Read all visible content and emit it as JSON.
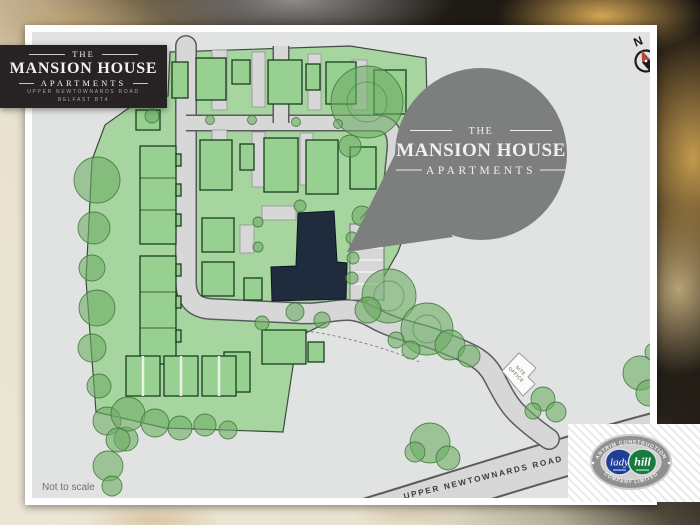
{
  "badge": {
    "the": "THE",
    "title": "MANSION HOUSE",
    "subtitle": "APARTMENTS",
    "address1": "UPPER NEWTOWNARDS ROAD",
    "address2": "BELFAST BT4"
  },
  "callout": {
    "the": "THE",
    "title": "MANSION HOUSE",
    "subtitle": "APARTMENTS"
  },
  "compass": {
    "north": "N",
    "south": "S"
  },
  "map": {
    "road_label": "UPPER NEWTOWNARDS ROAD",
    "site_office_line1": "SITE",
    "site_office_line2": "OFFICE",
    "scale_note": "Not to scale"
  },
  "builder": {
    "arc_top": "ANTRIM CONSTRUCTION",
    "arc_bottom": "COMPANY LIMITED",
    "script_left": "lady",
    "script_right": "hill",
    "separator": "◆"
  },
  "colors": {
    "badge_bg": "#272324",
    "callout_bg": "#7d7f7f",
    "map_bg": "#e1e3e2",
    "site_green": "#a7d5a0",
    "house_green": "#98d091",
    "tree_green": "#6cae64",
    "road_gray": "#d6d7d6",
    "building_navy": "#1e2c3d",
    "logo_blue": "#1f3e96",
    "logo_green": "#177a3e",
    "compass_red": "#b5433a"
  }
}
